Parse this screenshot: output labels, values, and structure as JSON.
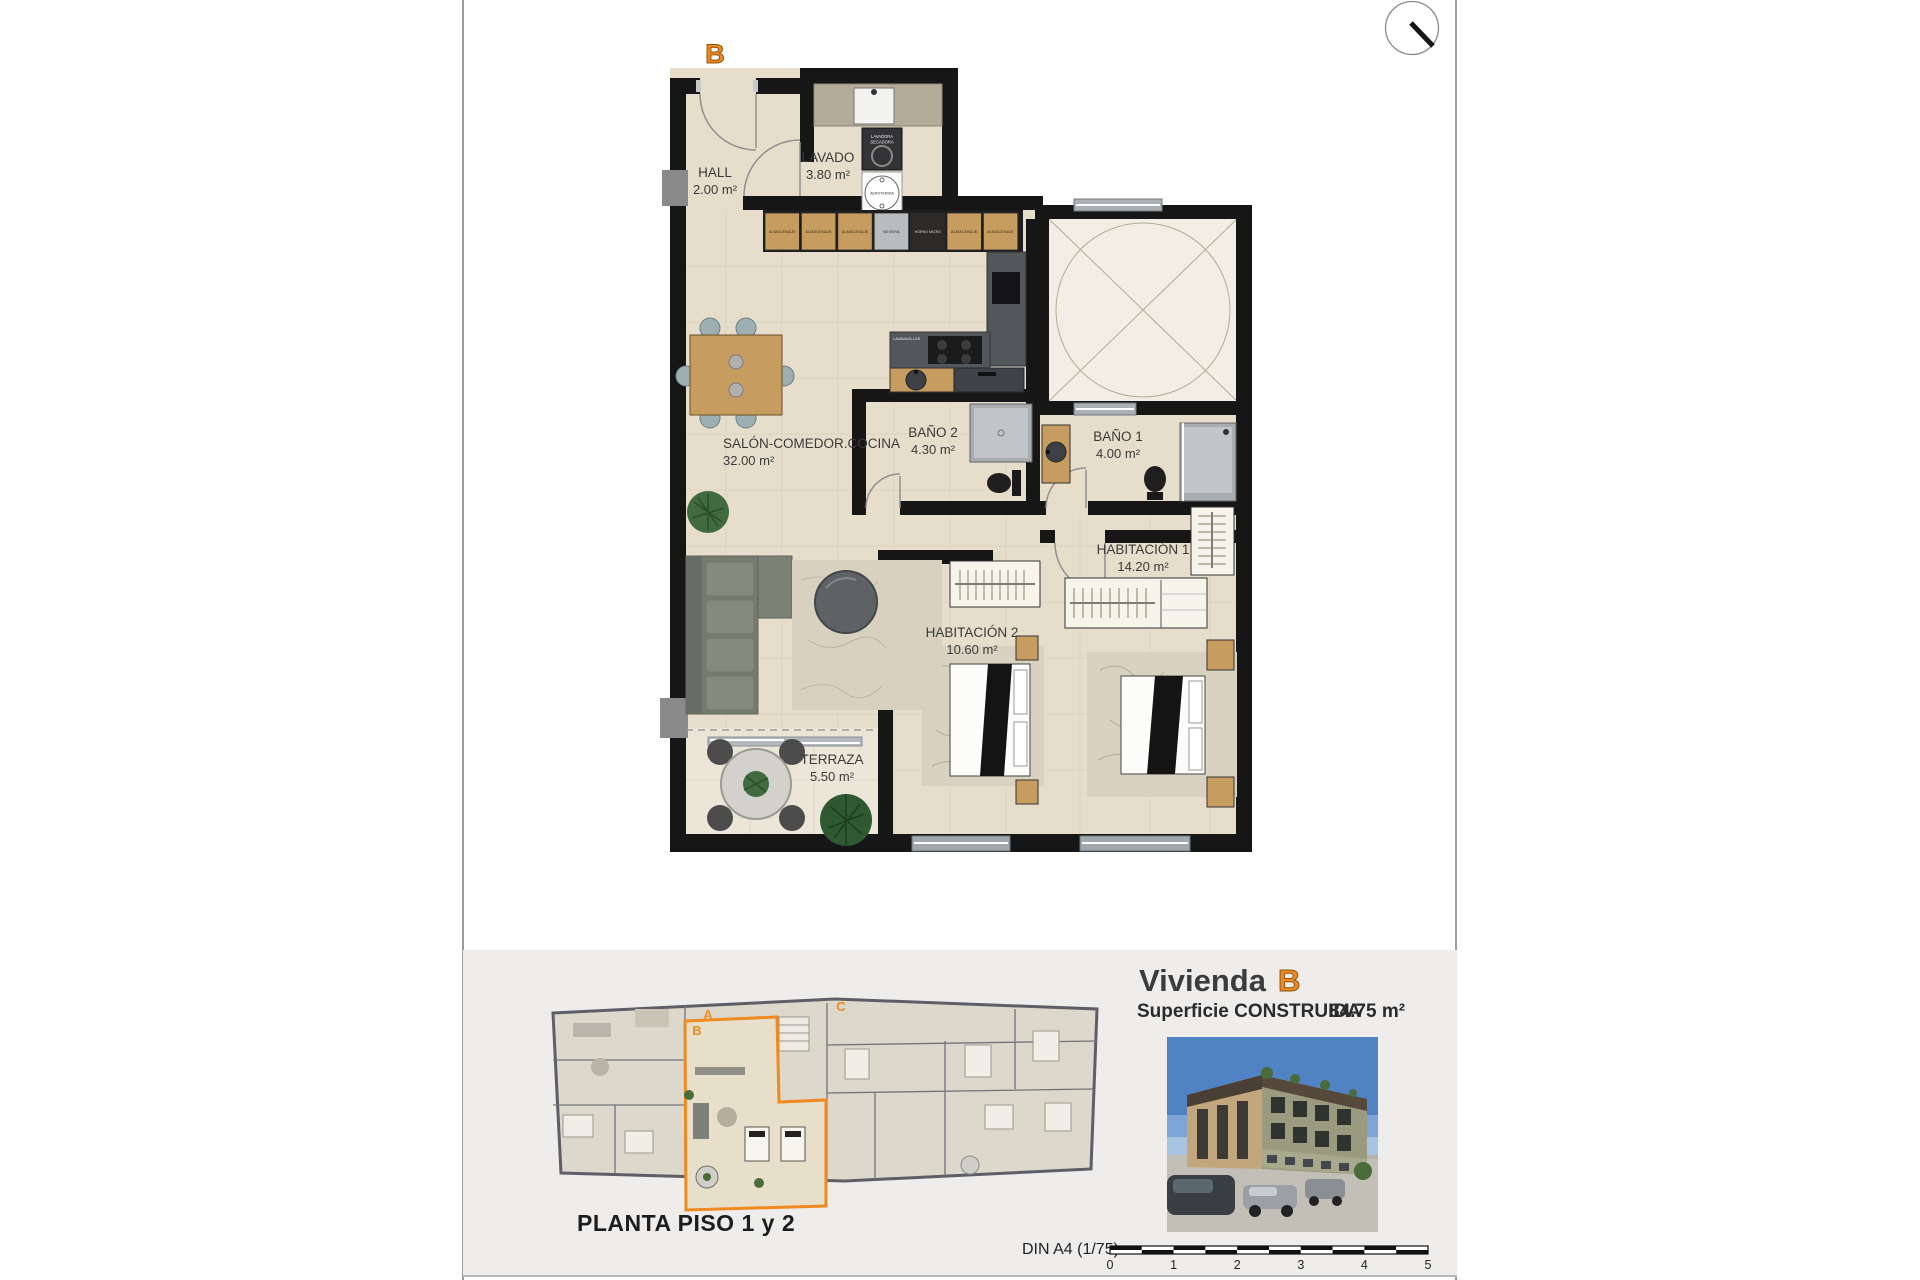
{
  "plan": {
    "unit_label": "B",
    "rooms": {
      "hall": {
        "name": "HALL",
        "area": "2.00 m²"
      },
      "lavado": {
        "name": "LAVADO",
        "area": "3.80 m²"
      },
      "salon": {
        "name": "SALÓN-COMEDOR.COCINA",
        "area": "32.00 m²"
      },
      "bano2": {
        "name": "BAÑO 2",
        "area": "4.30 m²"
      },
      "bano1": {
        "name": "BAÑO 1",
        "area": "4.00 m²"
      },
      "hab1": {
        "name": "HABITACIÓN 1",
        "area": "14.20 m²"
      },
      "hab2": {
        "name": "HABITACIÓN 2",
        "area": "10.60 m²"
      },
      "terraza": {
        "name": "TERRAZA",
        "area": "5.50 m²"
      }
    },
    "kitchen": {
      "cabinets": [
        "ALMACENAJE",
        "ALMACENAJE",
        "ALMACENAJE",
        "NEVERA",
        "HORNO MICRO",
        "ALMACENAJE",
        "ALMACENAJE"
      ],
      "dishwasher": "LAVAVAJILLAS"
    },
    "laundry": {
      "washer_line1": "LAVADORA",
      "washer_line2": "SECADORA",
      "aerothermal": "AEROTERMIA"
    }
  },
  "footer": {
    "site_plan_title": "PLANTA PISO 1 y 2",
    "site_letters": [
      "A",
      "B",
      "C"
    ],
    "dwelling_word": "Vivienda",
    "dwelling_letter": "B",
    "surface_label": "Superficie CONSTRUIDA",
    "surface_value": "84.75 m²",
    "sheet_scale_label": "DIN A4 (1/75)",
    "scale_ticks": [
      "0",
      "1",
      "2",
      "3",
      "4",
      "5"
    ]
  },
  "colors": {
    "accent_orange": "#ee8a1f",
    "wall_black": "#161616",
    "floor_beige": "#e6ddcb",
    "panel_gray": "#eeedec"
  }
}
